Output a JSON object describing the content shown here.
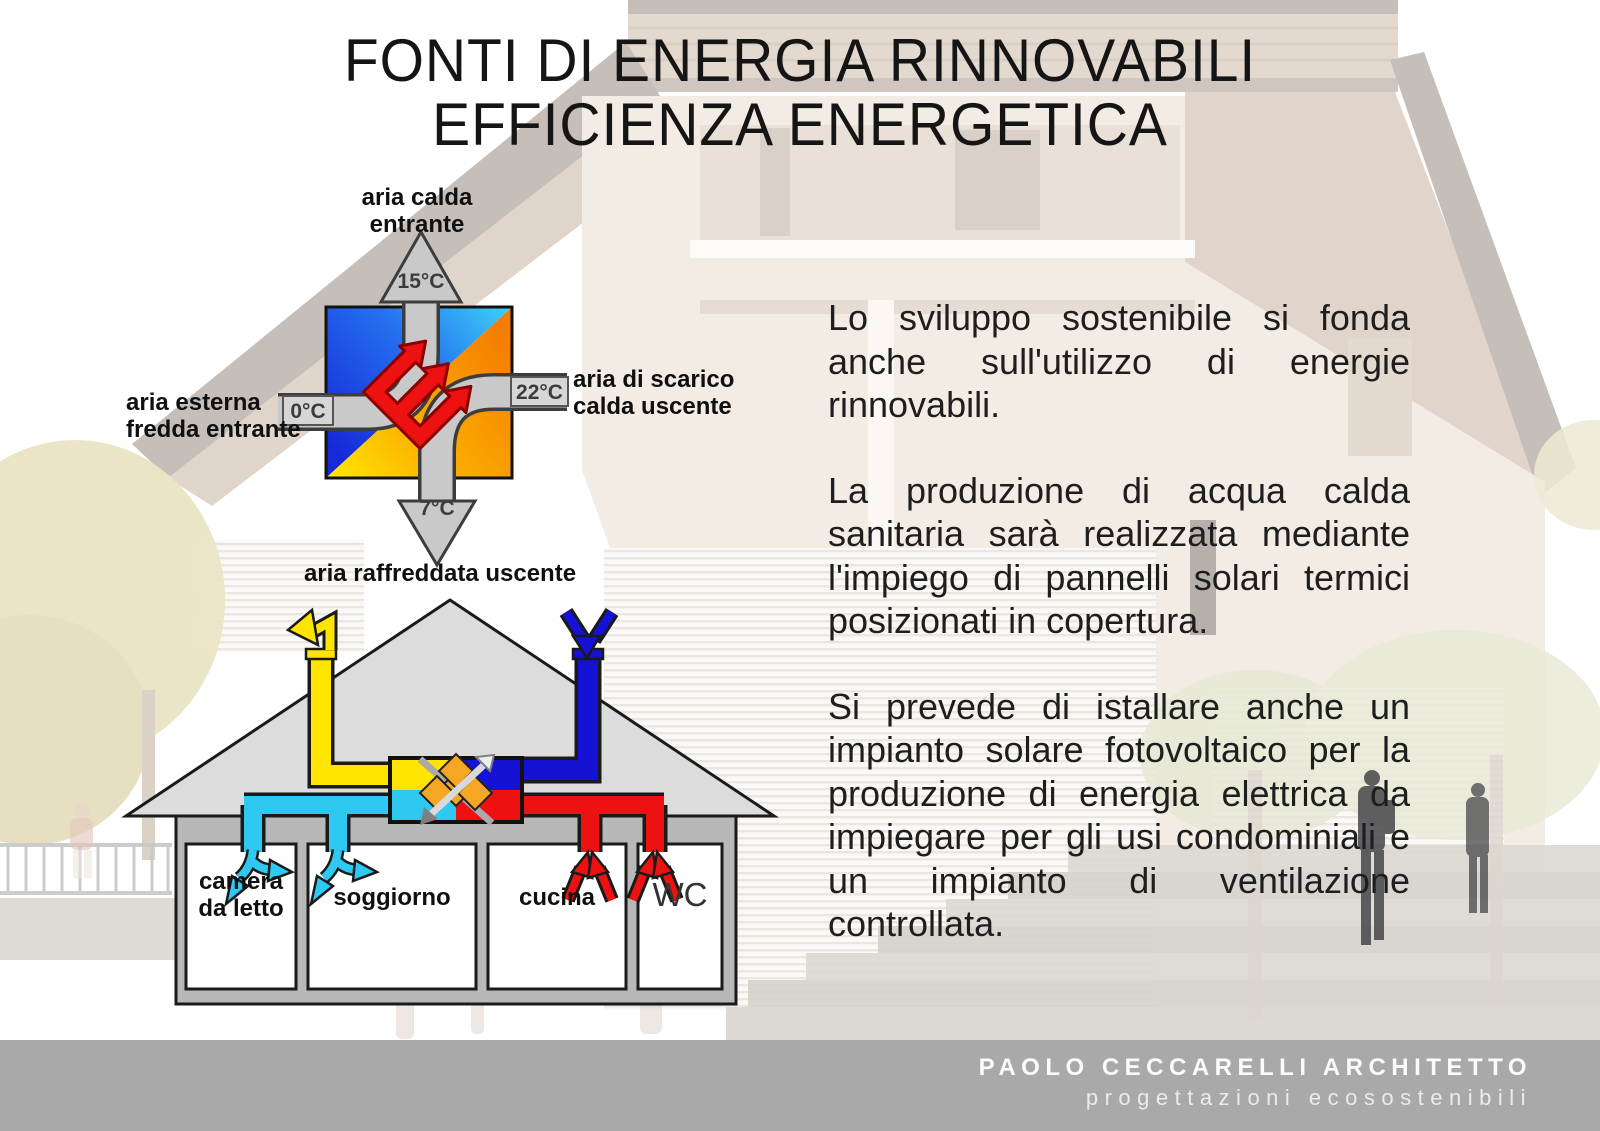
{
  "title": {
    "line1": "FONTI DI ENERGIA RINNOVABILI",
    "line2": "EFFICIENZA ENERGETICA"
  },
  "exchanger": {
    "label_top": "aria calda entrante",
    "label_left": "aria esterna fredda entrante",
    "label_right": "aria di scarico calda uscente",
    "label_bottom": "aria raffreddata uscente",
    "temp_top": "15°C",
    "temp_left": "0°C",
    "temp_right": "22°C",
    "temp_bottom": "7°C"
  },
  "house": {
    "rooms": [
      "camera da letto",
      "soggiorno",
      "cucina",
      "WC"
    ]
  },
  "paragraphs": [
    "Lo sviluppo sostenibile si fonda anche sull'utilizzo di energie rinnovabili.",
    "La produzione di acqua calda sanitaria sarà realizzata mediante l'impiego di pannelli solari termici posizionati in copertura.",
    "Si prevede di istallare anche un impianto solare fotovoltaico per la produzione di energia elettrica da impiegare per gli usi condominiali e un impianto di ventilazione controllata."
  ],
  "footer": {
    "line1": "PAOLO CECCARELLI ARCHITETTO",
    "line2": "progettazioni ecosostenibili"
  },
  "colors": {
    "cold_blue": "#1c2fd6",
    "cyan": "#2fc8f0",
    "warm_orange": "#f57e00",
    "yellow": "#ffe400",
    "red": "#ee1111",
    "pipe_gray": "#c9c9c9",
    "roof_gray": "#dcdcdc",
    "wall_gray": "#b8b8b8",
    "footer_gray": "#a9a9a9"
  }
}
